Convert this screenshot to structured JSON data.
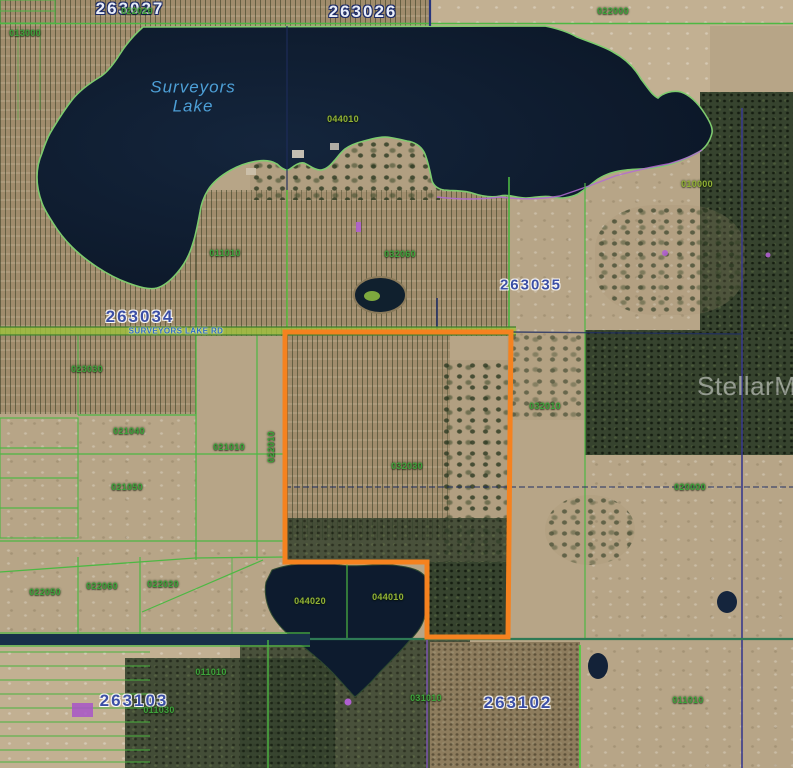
{
  "map": {
    "watermark": "StellarMLS",
    "road_label": "SURVEYORS LAKE RD",
    "lake_name_line1": "Surveyors",
    "lake_name_line2": "Lake"
  },
  "municipal_labels": [
    {
      "id": "263027",
      "text": "263027"
    },
    {
      "id": "263026",
      "text": "263026"
    },
    {
      "id": "263034",
      "text": "263034"
    },
    {
      "id": "263035",
      "text": "263035"
    },
    {
      "id": "263103",
      "text": "263103"
    },
    {
      "id": "263102",
      "text": "263102"
    }
  ],
  "parcel_labels": [
    {
      "id": "022020-top",
      "text": "022020"
    },
    {
      "id": "013000",
      "text": "013000"
    },
    {
      "id": "022000",
      "text": "022000"
    },
    {
      "id": "044010-north",
      "text": "044010"
    },
    {
      "id": "010000",
      "text": "010000"
    },
    {
      "id": "011010-center",
      "text": "011010"
    },
    {
      "id": "032060",
      "text": "032060"
    },
    {
      "id": "023030",
      "text": "023030"
    },
    {
      "id": "021040",
      "text": "021040"
    },
    {
      "id": "021010",
      "text": "021010"
    },
    {
      "id": "022010",
      "text": "022010"
    },
    {
      "id": "021050",
      "text": "021050"
    },
    {
      "id": "032030",
      "text": "032030"
    },
    {
      "id": "032010",
      "text": "032010"
    },
    {
      "id": "020000",
      "text": "020000"
    },
    {
      "id": "022050",
      "text": "022050"
    },
    {
      "id": "022060",
      "text": "022060"
    },
    {
      "id": "022020-south",
      "text": "022020"
    },
    {
      "id": "044020",
      "text": "044020"
    },
    {
      "id": "044010-south",
      "text": "044010"
    },
    {
      "id": "011010-southwest",
      "text": "011010"
    },
    {
      "id": "011030",
      "text": "011030"
    },
    {
      "id": "031010",
      "text": "031010"
    },
    {
      "id": "011010-southeast",
      "text": "011010"
    }
  ],
  "colors": {
    "highlight_parcel_orange": "#F5821F",
    "parcel_line_green": "#4DB843",
    "parcel_label_green": "#3DA33B",
    "section_line_navy": "#27357E",
    "road_label_blue": "#2E6BC4",
    "lake_water": "#0E1C30",
    "municipal_label_blue": "#3C4FA5",
    "shoreline_purple": "#B36BD4",
    "watermark_white": "#FFFFFF"
  }
}
